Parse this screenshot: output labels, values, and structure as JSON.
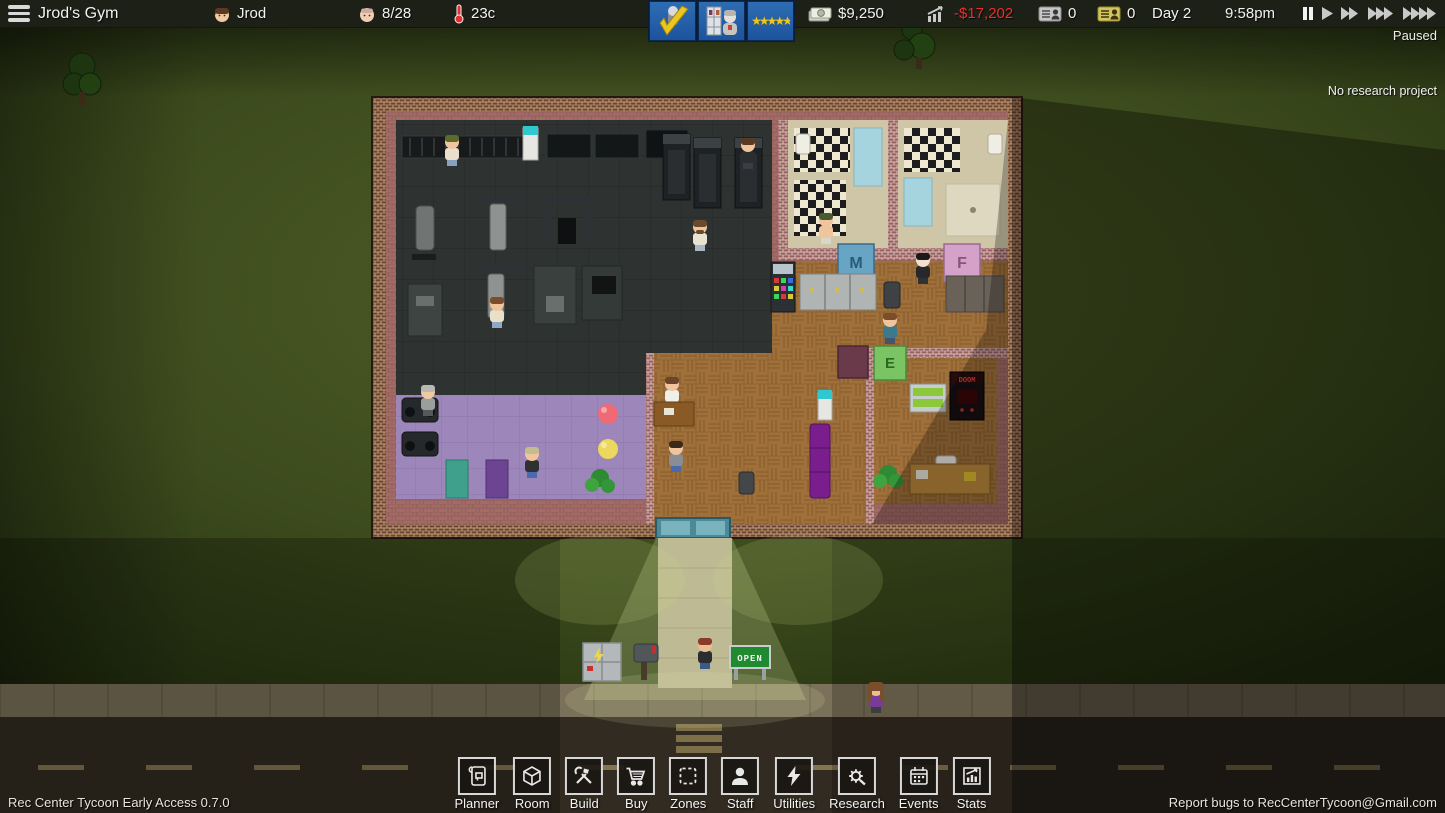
{
  "top_bar": {
    "gym_name": "Jrod's Gym",
    "player_name": "Jrod",
    "member_count": "8/28",
    "temperature": "23c",
    "cash": "$9,250",
    "profit": "-$17,202",
    "gray_card_count": "0",
    "yellow_card_count": "0",
    "day": "Day 2",
    "time": "9:58pm",
    "paused_label": "Paused",
    "rating_stars": "★★★★★"
  },
  "research_banner": "No research project",
  "toolbar": {
    "buttons": [
      {
        "label": "Planner"
      },
      {
        "label": "Room"
      },
      {
        "label": "Build"
      },
      {
        "label": "Buy"
      },
      {
        "label": "Zones"
      },
      {
        "label": "Staff"
      },
      {
        "label": "Utilities"
      },
      {
        "label": "Research"
      },
      {
        "label": "Events"
      },
      {
        "label": "Stats"
      }
    ]
  },
  "footer": {
    "version": "Rec Center Tycoon Early Access 0.7.0",
    "report_bugs": "Report bugs to RecCenterTycoon@Gmail.com"
  },
  "world": {
    "male_door_label": "M",
    "female_door_label": "F",
    "employee_door_label": "E",
    "open_sign": "OPEN",
    "arcade_name": "DOOM"
  },
  "colors": {
    "hud_bg": "#1d2016",
    "profit_negative": "#e83030",
    "notification_blue": "#2d6db4",
    "grass": "#3c4b1d",
    "brick_wall": "#6e4434",
    "purple_room": "#9c86ba",
    "gym_floor": "#2e3331",
    "wood_floor": "#a0703a"
  }
}
